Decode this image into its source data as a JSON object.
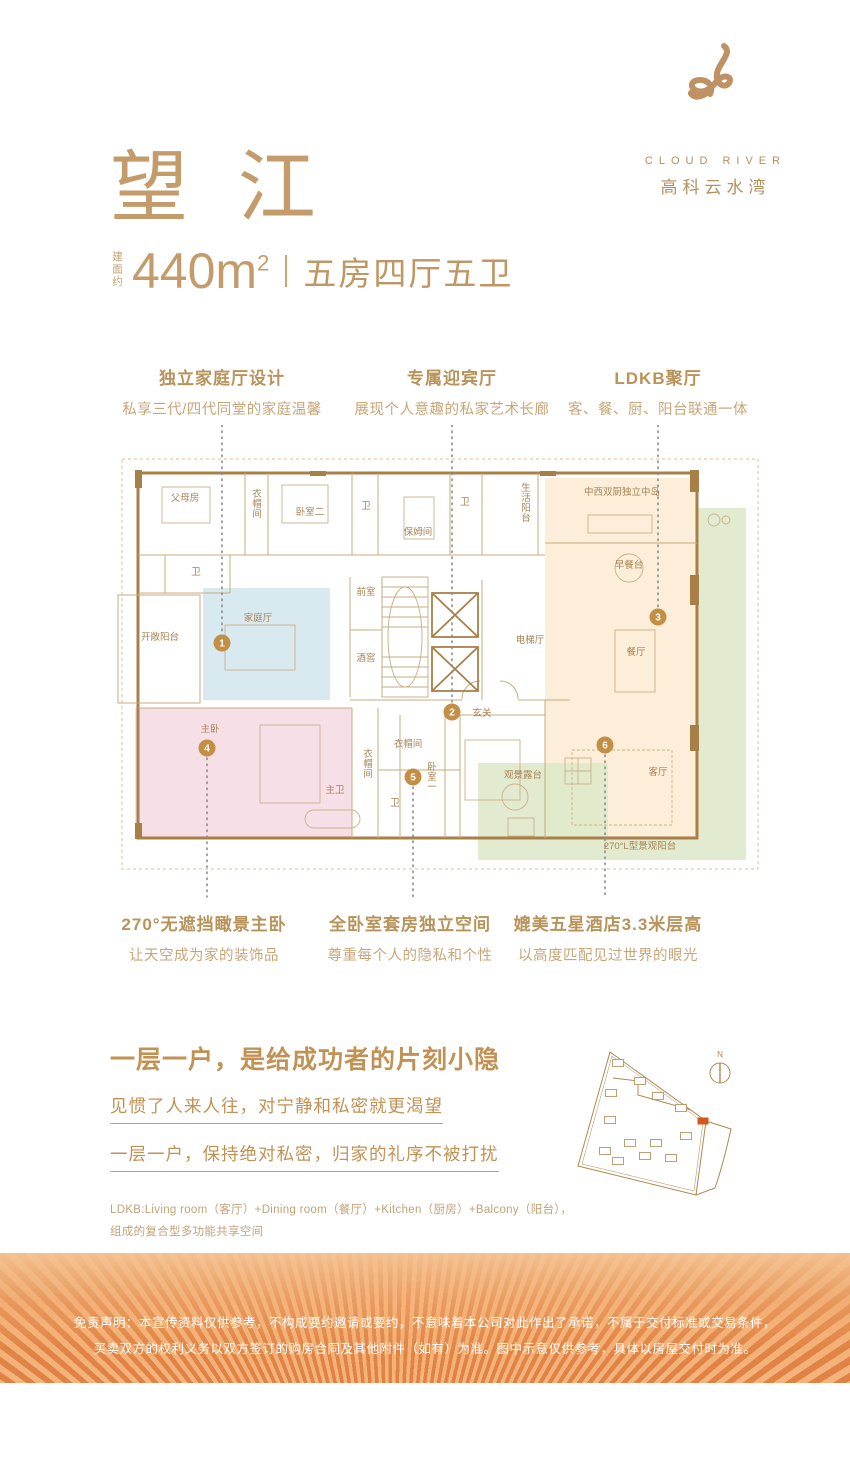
{
  "brand": {
    "logo_en": "CLOUD RIVER",
    "logo_cn": "高科云水湾"
  },
  "header": {
    "title": "望 江",
    "area_prefix": "建面约",
    "area_value": "440m",
    "area_sup": "2",
    "spec": "五房四厅五卫"
  },
  "callouts_top": [
    {
      "title": "独立家庭厅设计",
      "desc": "私享三代/四代同堂的家庭温馨"
    },
    {
      "title": "专属迎宾厅",
      "desc": "展现个人意趣的私家艺术长廊"
    },
    {
      "title": "LDKB聚厅",
      "desc": "客、餐、厨、阳台联通一体"
    }
  ],
  "callouts_bottom": [
    {
      "title": "270°无遮挡瞰景主卧",
      "desc": "让天空成为家的装饰品"
    },
    {
      "title": "全卧室套房独立空间",
      "desc": "尊重每个人的隐私和个性"
    },
    {
      "title": "媲美五星酒店3.3米层高",
      "desc": "以高度匹配见过世界的眼光"
    }
  ],
  "floorplan": {
    "colors": {
      "family": "#d4e7ee",
      "master": "#f6dbe6",
      "ldkb": "#fcecd4",
      "terrace": "#dfe9cb",
      "marker": "#c28f44",
      "wall": "#a97f48",
      "partition": "#c9ab7e",
      "label": "#a98354",
      "leader": "#8c8c8c"
    },
    "rooms": [
      {
        "label": "父母房",
        "x": 75,
        "y": 76
      },
      {
        "label": "衣帽间",
        "x": 147,
        "y": 72,
        "v": true
      },
      {
        "label": "卧室二",
        "x": 200,
        "y": 90
      },
      {
        "label": "卫",
        "x": 256,
        "y": 84
      },
      {
        "label": "保姆间",
        "x": 308,
        "y": 110
      },
      {
        "label": "卫",
        "x": 355,
        "y": 80
      },
      {
        "label": "生活阳台",
        "x": 416,
        "y": 66,
        "v": true
      },
      {
        "label": "卫",
        "x": 86,
        "y": 150
      },
      {
        "label": "开敞阳台",
        "x": 50,
        "y": 215
      },
      {
        "label": "家庭厅",
        "x": 148,
        "y": 196
      },
      {
        "label": "前室",
        "x": 256,
        "y": 170
      },
      {
        "label": "酒窖",
        "x": 256,
        "y": 236
      },
      {
        "label": "电梯厅",
        "x": 420,
        "y": 218
      },
      {
        "label": "玄关",
        "x": 372,
        "y": 291
      },
      {
        "label": "中西双厨独立中岛",
        "x": 512,
        "y": 70
      },
      {
        "label": "早餐台",
        "x": 519,
        "y": 143
      },
      {
        "label": "餐厅",
        "x": 526,
        "y": 230
      },
      {
        "label": "客厅",
        "x": 548,
        "y": 350
      },
      {
        "label": "观景露台",
        "x": 413,
        "y": 353
      },
      {
        "label": "270°L型景观阳台",
        "x": 530,
        "y": 424
      },
      {
        "label": "主卧",
        "x": 100,
        "y": 307
      },
      {
        "label": "衣帽间",
        "x": 258,
        "y": 332,
        "v": true
      },
      {
        "label": "主卫",
        "x": 225,
        "y": 368
      },
      {
        "label": "衣帽间",
        "x": 298,
        "y": 322
      },
      {
        "label": "卫",
        "x": 285,
        "y": 381
      },
      {
        "label": "卧室一",
        "x": 322,
        "y": 345,
        "v": true
      }
    ],
    "markers": [
      {
        "n": "1",
        "x": 112,
        "y": 218
      },
      {
        "n": "2",
        "x": 342,
        "y": 287
      },
      {
        "n": "3",
        "x": 548,
        "y": 192
      },
      {
        "n": "4",
        "x": 97,
        "y": 323
      },
      {
        "n": "5",
        "x": 303,
        "y": 352
      },
      {
        "n": "6",
        "x": 495,
        "y": 320
      }
    ],
    "leaders": [
      {
        "x": 112,
        "y1": 0,
        "y2": 208
      },
      {
        "x": 342,
        "y1": 0,
        "y2": 277
      },
      {
        "x": 548,
        "y1": 0,
        "y2": 182
      },
      {
        "x": 97,
        "y1": 333,
        "y2": 472
      },
      {
        "x": 303,
        "y1": 362,
        "y2": 472
      },
      {
        "x": 495,
        "y1": 330,
        "y2": 472
      }
    ]
  },
  "statement": {
    "heading": "一层一户，是给成功者的片刻小隐",
    "line1": "见惯了人来人往，对宁静和私密就更渴望",
    "line2": "一层一户，保持绝对私密，归家的礼序不被打扰",
    "footnote1": "LDKB:Living room（客厅）+Dining room（餐厅）+Kitchen（厨房）+Balcony（阳台），",
    "footnote2": "组成的复合型多功能共享空间"
  },
  "siteplan": {
    "north_label": "N",
    "highlight_color": "#d2571d",
    "buildings": [
      [
        45,
        30
      ],
      [
        67,
        48
      ],
      [
        38,
        60
      ],
      [
        85,
        63
      ],
      [
        108,
        75
      ],
      [
        37,
        87
      ],
      [
        57,
        110
      ],
      [
        83,
        110
      ],
      [
        113,
        103
      ],
      [
        32,
        118
      ],
      [
        98,
        125
      ],
      [
        45,
        128
      ],
      [
        72,
        123
      ]
    ],
    "highlight": [
      130,
      88
    ]
  },
  "disclaimer": {
    "line1": "免责声明：本宣传资料仅供参考，不构成要约邀请或要约，不意味着本公司对此作出了承诺，不属于交付标准或交易条件，",
    "line2": "买卖双方的权利义务以双方签订的购房合同及其他附件（如有）为准。图中示意仅供参考，具体以房屋交付时为准。"
  }
}
